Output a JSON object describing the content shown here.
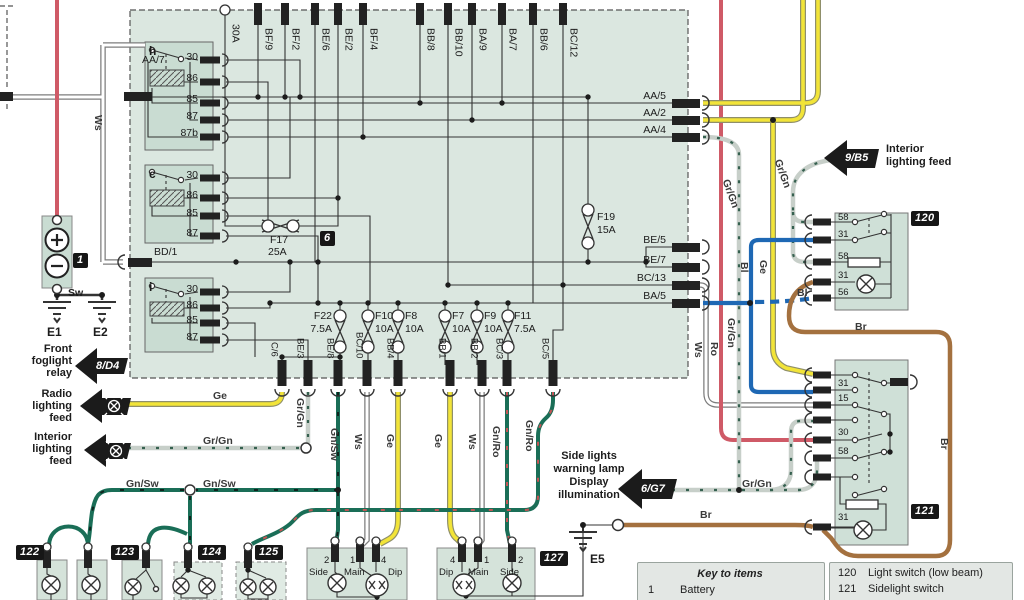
{
  "colors": {
    "red": "#cf5a67",
    "yellow": "#f2e438",
    "blue": "#1e68b4",
    "brown": "#a4713f",
    "green": "#1a6e57",
    "gray_green": "#c7cfc9",
    "sage": "#dbe7e0",
    "badge_black": "#161616"
  },
  "fusebox": {
    "badge": "6",
    "inlet": "30A",
    "top": [
      "BF/9",
      "BF/2",
      "BE/6",
      "BE/2",
      "BF/4",
      "BB/8",
      "BB/10",
      "BA/9",
      "BA/7",
      "BB/6",
      "BC/12"
    ],
    "left": {
      "aa7": "AA/7",
      "bd1": "BD/1"
    },
    "right": [
      "AA/5",
      "AA/2",
      "AA/4",
      "BE/5",
      "BE/7",
      "BC/13",
      "BA/5"
    ],
    "bottom": [
      "C/6",
      "BE/3",
      "BE/8",
      "BC/10",
      "BB/4",
      "BB/1",
      "BB/2",
      "BC/3",
      "BC/5"
    ],
    "relays": [
      {
        "id": "h",
        "pins": [
          "30",
          "86",
          "85",
          "87",
          "87b"
        ]
      },
      {
        "id": "c",
        "pins": [
          "30",
          "86",
          "85",
          "87"
        ]
      },
      {
        "id": "i",
        "pins": [
          "30",
          "86",
          "85",
          "87"
        ]
      }
    ],
    "fuses": {
      "f17": [
        "F17",
        "25A"
      ],
      "f19": [
        "F19",
        "15A"
      ],
      "f22": [
        "F22",
        "7.5A"
      ],
      "f10": [
        "F10",
        "10A"
      ],
      "f8": [
        "F8",
        "10A"
      ],
      "f7": [
        "F7",
        "10A"
      ],
      "f9": [
        "F9",
        "10A"
      ],
      "f11": [
        "F11",
        "7.5A"
      ]
    }
  },
  "battery": {
    "badge": "1",
    "sw": "Sw"
  },
  "grounds": {
    "e1": "E1",
    "e2": "E2",
    "e5": "E5"
  },
  "feeds": {
    "foglight": {
      "ref": "8/D4",
      "lines": [
        "Front",
        "foglight",
        "relay"
      ]
    },
    "radio": {
      "lines": [
        "Radio",
        "lighting",
        "feed"
      ]
    },
    "interior_left": {
      "lines": [
        "Interior",
        "lighting",
        "feed"
      ]
    },
    "interior_right": {
      "ref": "9/B5",
      "lines": [
        "Interior",
        "lighting feed"
      ]
    },
    "sidelight": {
      "ref": "6/G7",
      "lines": [
        "Side lights",
        "warning lamp",
        "Display",
        "illumination"
      ]
    }
  },
  "light_switch": {
    "badge": "120",
    "pins": [
      "58",
      "31",
      "58",
      "31",
      "56"
    ]
  },
  "sidelight_switch": {
    "badge": "121",
    "pins": [
      "31",
      "15",
      "30",
      "58",
      "31"
    ]
  },
  "lamp_units": {
    "u122": "122",
    "u123": "123",
    "u124": "124",
    "u125": "125",
    "u127": "127"
  },
  "headlamp_left": {
    "pins": [
      "2",
      "1",
      "4"
    ],
    "labels": [
      "Side",
      "Main",
      "Dip"
    ]
  },
  "headlamp_right": {
    "pins": [
      "4",
      "1",
      "2"
    ],
    "labels": [
      "Dip",
      "Main",
      "Side"
    ]
  },
  "wires": {
    "ws": "Ws",
    "ge": "Ge",
    "grgn": "Gr/Gn",
    "gnsw": "Gn/Sw",
    "gnro": "Gn/Ro",
    "ro": "Ro",
    "bl": "Bl",
    "br": "Br"
  },
  "key": {
    "title": "Key to items",
    "col1": [
      {
        "num": "1",
        "name": "Battery"
      }
    ],
    "col2": [
      {
        "num": "120",
        "name": "Light switch (low beam)"
      },
      {
        "num": "121",
        "name": "Sidelight switch"
      }
    ]
  }
}
